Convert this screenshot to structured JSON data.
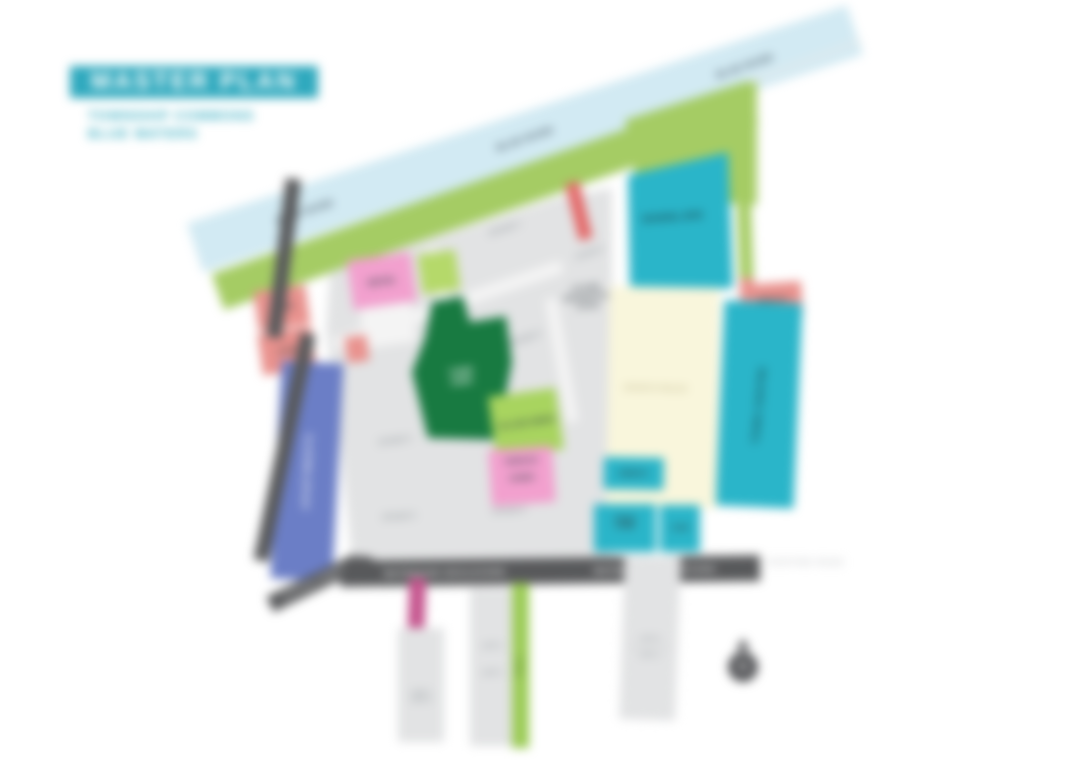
{
  "header": {
    "title": "MASTER PLAN",
    "subtitle_line1": "TOWNSHIP COMMONS",
    "subtitle_line2": "BLUE WATERS"
  },
  "river": {
    "labels": [
      "BLUE RIVER",
      "BLUE RIVER",
      "BLUE RIVER"
    ]
  },
  "roads": {
    "boulevard_label_west": "WATERSIDE BOULEVARD",
    "boulevard_label_east": "WATERSIDE BOULEVARD",
    "branch_label": "STATION STREET",
    "offsite_label": "EXISTING ROAD"
  },
  "parcels": {
    "school": {
      "label": "SCHOOL SITE",
      "color": "#2AB5C9"
    },
    "medical": {
      "label": "MEDICAL",
      "color": "#E9928E"
    },
    "town_centre": {
      "label": "TOWN CENTRE",
      "color": "#2AB5C9"
    },
    "sports": {
      "label": "SPORTS FIELDS",
      "color": "#F9F6DC"
    },
    "amenity": {
      "label": "AMENITY",
      "color": "#2AB5C9"
    },
    "childcare": {
      "label_line1": "CHILD",
      "label_line2": "CARE",
      "color": "#2AB5C9"
    },
    "gym": {
      "label": "GYM",
      "color": "#2AB5C9"
    },
    "town_park": {
      "label_line1": "TOWN",
      "label_line2": "PARK",
      "color": "#187A41"
    },
    "village_green": {
      "label": "VILLAGE GREEN",
      "color": "#A8D45F"
    },
    "terrace_homes": {
      "label_line1": "TERRACE",
      "label_line2": "HOMES",
      "color": "#F2A0CE"
    },
    "retail": {
      "label": "RETAIL",
      "color": "#F2A0CE"
    },
    "shops": {
      "label": "SHOPS",
      "color": "#E9928E"
    },
    "cafe": {
      "label": "CAFE",
      "color": "#E9928E"
    },
    "apartments": {
      "label": "APARTMENTS",
      "color": "#6B7EC6"
    },
    "future_residential": {
      "label_line1": "FUTURE",
      "label_line2": "RESIDENTIAL",
      "label_line3": "STAGE"
    },
    "stage_labels": [
      "STAGE 1",
      "STAGE 2",
      "STAGE 3",
      "STAGE 4",
      "STAGE 5",
      "STAGE 6"
    ],
    "lots_south": {
      "lot_a": "LOT 1",
      "lot_b": "LOT 2",
      "lot_c": "LOT 3",
      "lot_d": "LOT 4",
      "lot_e": "LOT 5",
      "trail": "TRAIL"
    }
  },
  "compass": {
    "label": "N"
  },
  "colors": {
    "accent_teal": "#2FA9BE",
    "river_blue": "#D2EAF3",
    "parkland_green": "#A5CC64",
    "parcel_cyan": "#2AB5C9",
    "parcel_cream": "#F9F6DC",
    "parcel_dark_green": "#187A41",
    "parcel_pink": "#F2A0CE",
    "parcel_salmon": "#E9928E",
    "parcel_blue": "#6B7EC6",
    "road_gray": "#58595B",
    "lot_gray": "#E2E3E4",
    "strip_magenta": "#C5558E",
    "strip_green": "#9BCB55"
  }
}
